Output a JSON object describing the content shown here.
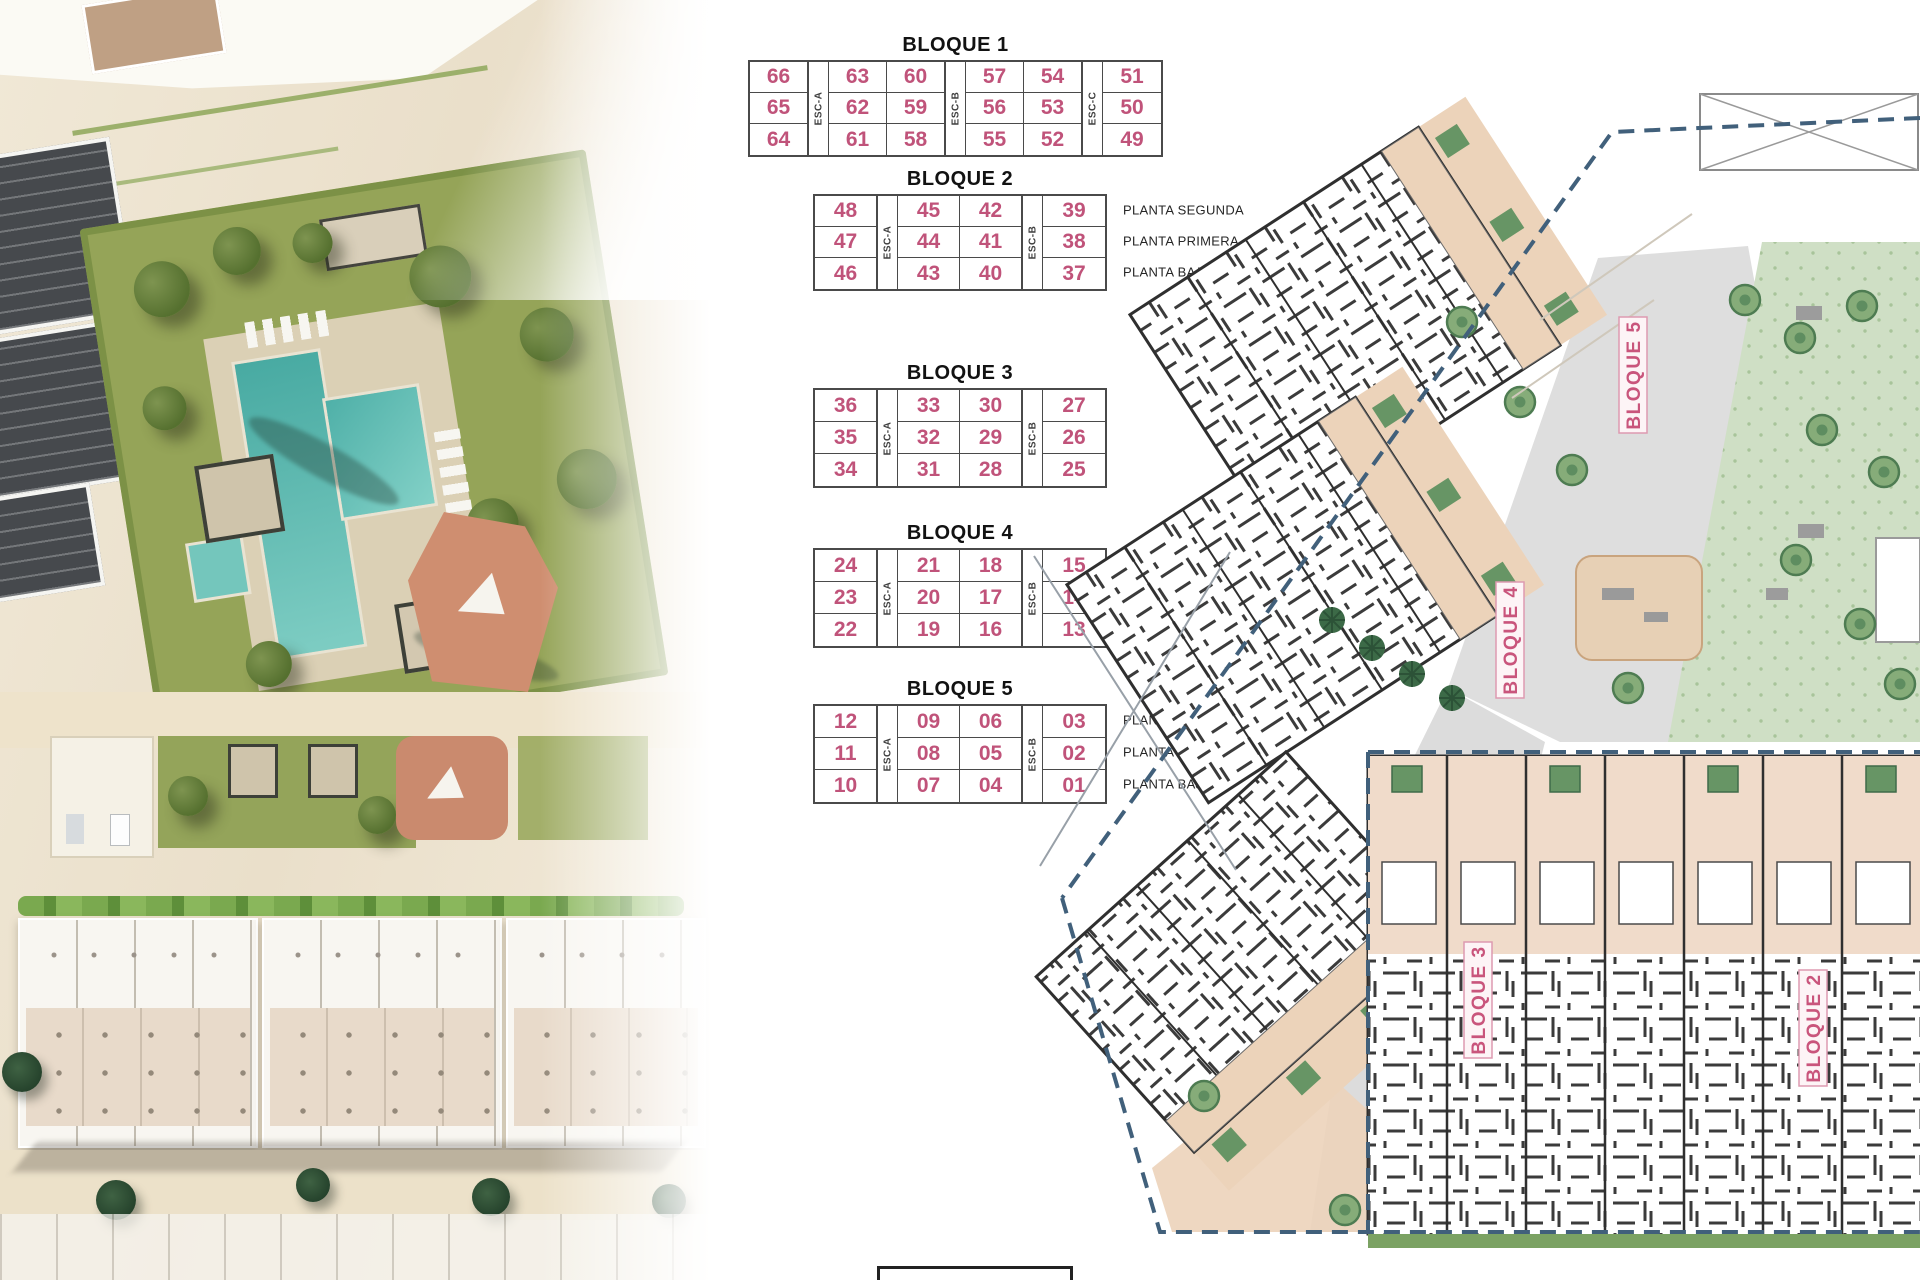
{
  "blocks": [
    {
      "name": "BLOQUE 1",
      "column_layout": [
        1,
        "ESC-A",
        2,
        "ESC-B",
        2,
        "ESC-C",
        1
      ],
      "rows": [
        [
          "66",
          "63",
          "60",
          "57",
          "54",
          "51"
        ],
        [
          "65",
          "62",
          "59",
          "56",
          "53",
          "50"
        ],
        [
          "64",
          "61",
          "58",
          "55",
          "52",
          "49"
        ]
      ],
      "floor_labels": []
    },
    {
      "name": "BLOQUE 2",
      "column_layout": [
        1,
        "ESC-A",
        2,
        "ESC-B",
        1
      ],
      "rows": [
        [
          "48",
          "45",
          "42",
          "39"
        ],
        [
          "47",
          "44",
          "41",
          "38"
        ],
        [
          "46",
          "43",
          "40",
          "37"
        ]
      ],
      "floor_labels": [
        "PLANTA SEGUNDA",
        "PLANTA PRIMERA",
        "PLANTA BAJA"
      ]
    },
    {
      "name": "BLOQUE 3",
      "column_layout": [
        1,
        "ESC-A",
        2,
        "ESC-B",
        1
      ],
      "rows": [
        [
          "36",
          "33",
          "30",
          "27"
        ],
        [
          "35",
          "32",
          "29",
          "26"
        ],
        [
          "34",
          "31",
          "28",
          "25"
        ]
      ],
      "floor_labels": []
    },
    {
      "name": "BLOQUE 4",
      "column_layout": [
        1,
        "ESC-A",
        2,
        "ESC-B",
        1
      ],
      "rows": [
        [
          "24",
          "21",
          "18",
          "15"
        ],
        [
          "23",
          "20",
          "17",
          "14"
        ],
        [
          "22",
          "19",
          "16",
          "13"
        ]
      ],
      "floor_labels": []
    },
    {
      "name": "BLOQUE 5",
      "column_layout": [
        1,
        "ESC-A",
        2,
        "ESC-B",
        1
      ],
      "rows": [
        [
          "12",
          "09",
          "06",
          "03"
        ],
        [
          "11",
          "08",
          "05",
          "02"
        ],
        [
          "10",
          "07",
          "04",
          "01"
        ]
      ],
      "floor_labels": [
        "PLANTA SEGUNDA",
        "PLANTA PRIMERA",
        "PLANTA BAJA"
      ]
    }
  ],
  "site_plan": {
    "labels": [
      {
        "text": "BLOQUE 5"
      },
      {
        "text": "BLOQUE 4"
      },
      {
        "text": "BLOQUE 3"
      },
      {
        "text": "BLOQUE 2"
      }
    ]
  },
  "colors": {
    "unit_number": "#c0537a",
    "plan_label": "#c9557c",
    "boundary": "#41607b",
    "pool": "#52b3aa",
    "garden_green": "#95a458",
    "terrace_tan": "#ecd3ba"
  }
}
